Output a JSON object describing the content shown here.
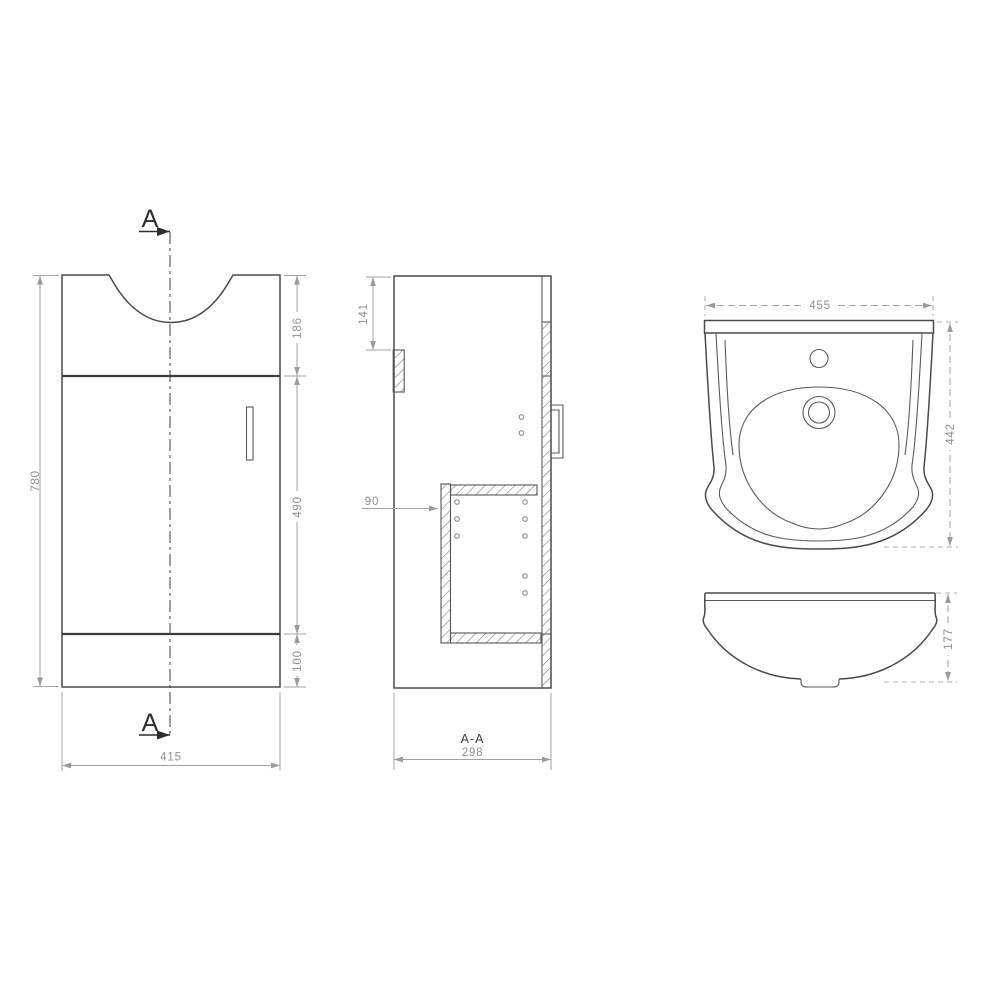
{
  "colors": {
    "background": "#ffffff",
    "object_line": "#4a4a4a",
    "dimension_line": "#a3a3a3",
    "dimension_text": "#8f8f8f",
    "section_marker_text": "#2d2d2d",
    "hatch": "#7d7d7d"
  },
  "section_marker": {
    "label": "A"
  },
  "front_view": {
    "overall_height_mm": "780",
    "basin_section_mm": "186",
    "door_section_mm": "490",
    "plinth_mm": "100",
    "overall_width_mm": "415"
  },
  "section_view": {
    "label": "A-A",
    "top_rail_offset_mm": "141",
    "shelf_inset_mm": "90",
    "overall_depth_mm": "298"
  },
  "basin_top_view": {
    "width_mm": "455",
    "depth_mm": "442"
  },
  "basin_front_view": {
    "height_mm": "177"
  }
}
